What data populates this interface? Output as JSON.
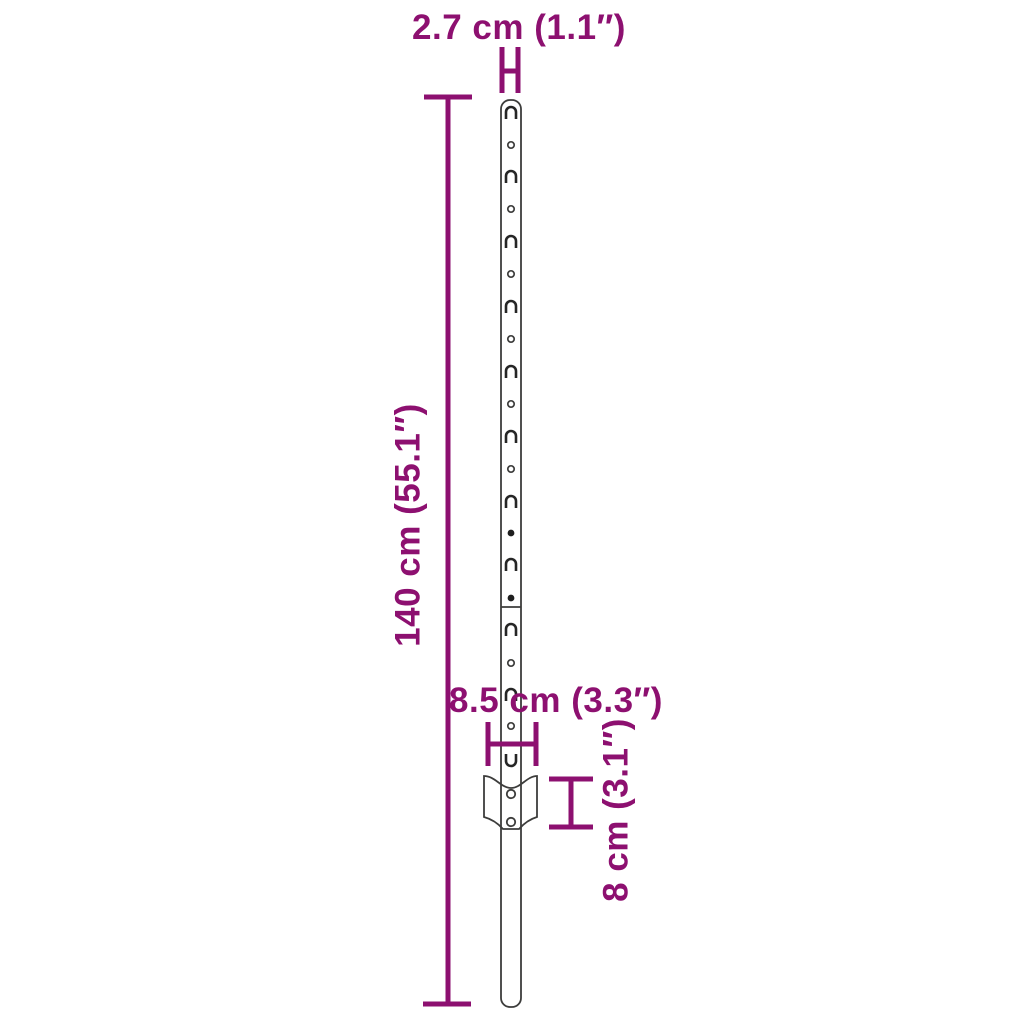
{
  "diagram": {
    "type": "product-dimension-diagram",
    "subject": "metal-u-fence-post",
    "colors": {
      "accent": "#8D1070",
      "line": "#3D3D3C",
      "background": "#FFFFFF"
    },
    "dimensions": {
      "width": {
        "label": "2.7 cm (1.1″)",
        "value_cm": 2.7,
        "value_in": 1.1
      },
      "height": {
        "label": "140 cm (55.1″)",
        "value_cm": 140,
        "value_in": 55.1
      },
      "plate_width": {
        "label": "8.5 cm (3.3″)",
        "value_cm": 8.5,
        "value_in": 3.3
      },
      "plate_height": {
        "label": "8 cm (3.1″)",
        "value_cm": 8,
        "value_in": 3.1
      }
    },
    "post": {
      "center_x": 511,
      "top_y": 100,
      "bottom_y": 1007,
      "seam_y": 607,
      "features": [
        {
          "y": 113,
          "type": "hook"
        },
        {
          "y": 145,
          "type": "hole"
        },
        {
          "y": 177,
          "type": "hook"
        },
        {
          "y": 209,
          "type": "hole"
        },
        {
          "y": 242,
          "type": "hook"
        },
        {
          "y": 274,
          "type": "hole"
        },
        {
          "y": 307,
          "type": "hook"
        },
        {
          "y": 339,
          "type": "hole"
        },
        {
          "y": 372,
          "type": "hook"
        },
        {
          "y": 404,
          "type": "hole"
        },
        {
          "y": 437,
          "type": "hook"
        },
        {
          "y": 469,
          "type": "hole"
        },
        {
          "y": 502,
          "type": "hook"
        },
        {
          "y": 533,
          "type": "dot"
        },
        {
          "y": 565,
          "type": "hook"
        },
        {
          "y": 598,
          "type": "dot"
        },
        {
          "y": 630,
          "type": "hook"
        },
        {
          "y": 663,
          "type": "hole"
        },
        {
          "y": 695,
          "type": "hook"
        },
        {
          "y": 726,
          "type": "hole"
        },
        {
          "y": 760,
          "type": "uslot"
        }
      ]
    }
  }
}
